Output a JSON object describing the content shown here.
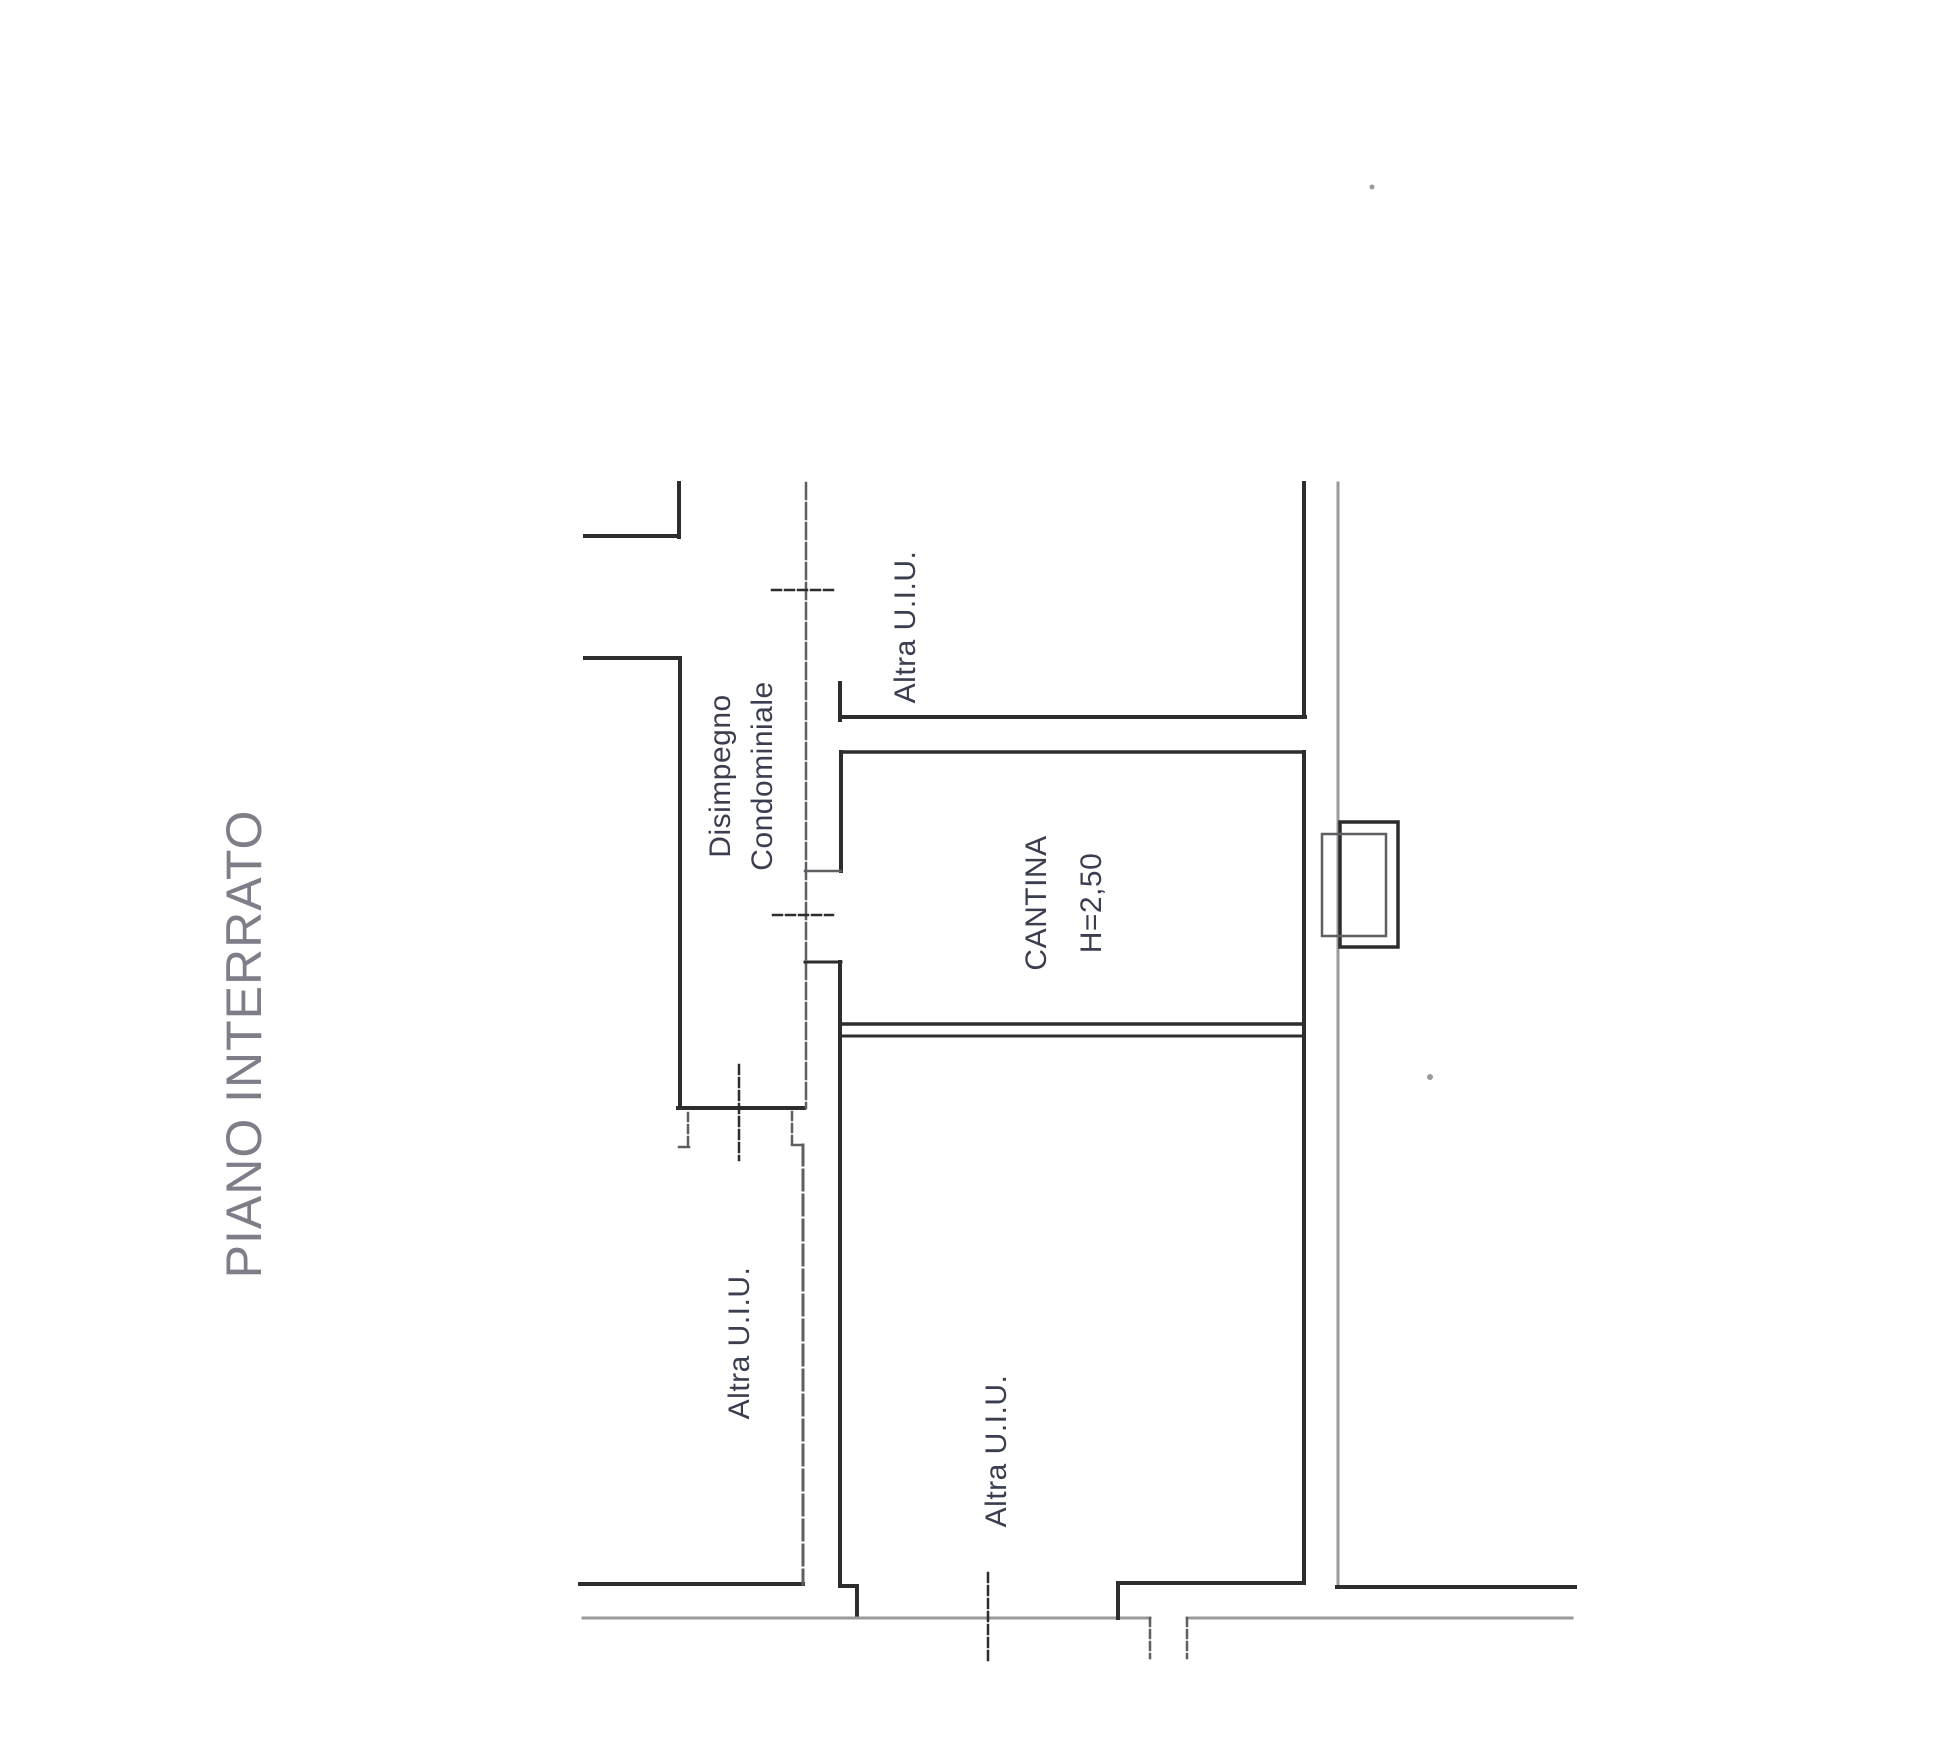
{
  "labels": {
    "floor_title": "PIANO INTERRATO",
    "corridor_line1": "Disimpegno",
    "corridor_line2": "Condominiale",
    "unit_top": "Altra U.I.U.",
    "unit_left": "Altra U.I.U.",
    "unit_bottom": "Altra U.I.U.",
    "room_name": "CANTINA",
    "room_height": "H=2,50"
  },
  "colors": {
    "ink": "#2d2d2f",
    "mid": "#5f5f63",
    "light": "#9a9a9a",
    "label_ink": "#3a3e4f",
    "title_ink": "#7e7e89"
  },
  "plan": {
    "segments": [
      {
        "name": "upper-notch-wall-v",
        "x1": 679,
        "y1": 483,
        "x2": 679,
        "y2": 537,
        "w": 4,
        "c": "ink",
        "dash": null
      },
      {
        "name": "upper-notch-wall-h",
        "x1": 585,
        "y1": 536,
        "x2": 679,
        "y2": 536,
        "w": 4,
        "c": "ink",
        "dash": null
      },
      {
        "name": "left-stub-wall-h",
        "x1": 585,
        "y1": 658,
        "x2": 680,
        "y2": 658,
        "w": 4,
        "c": "ink",
        "dash": null
      },
      {
        "name": "corridor-left-wall",
        "x1": 680,
        "y1": 658,
        "x2": 680,
        "y2": 1108,
        "w": 4,
        "c": "ink",
        "dash": null
      },
      {
        "name": "corridor-bottom-wall",
        "x1": 678,
        "y1": 1108,
        "x2": 804,
        "y2": 1108,
        "w": 4,
        "c": "ink",
        "dash": null
      },
      {
        "name": "corridor-boundary-line",
        "x1": 806,
        "y1": 483,
        "x2": 806,
        "y2": 1108,
        "w": 2.5,
        "c": "mid",
        "dash": "16 4"
      },
      {
        "name": "cantina-left-stub",
        "x1": 840,
        "y1": 683,
        "x2": 840,
        "y2": 720,
        "w": 4,
        "c": "ink",
        "dash": null
      },
      {
        "name": "cantina-top-wall-outer",
        "x1": 840,
        "y1": 717,
        "x2": 1305,
        "y2": 717,
        "w": 4,
        "c": "ink",
        "dash": null
      },
      {
        "name": "cantina-top-wall-inner",
        "x1": 842,
        "y1": 752,
        "x2": 1304,
        "y2": 752,
        "w": 3.5,
        "c": "ink",
        "dash": null
      },
      {
        "name": "cantina-left-wall-upper",
        "x1": 841,
        "y1": 752,
        "x2": 841,
        "y2": 871,
        "w": 4,
        "c": "ink",
        "dash": null
      },
      {
        "name": "cantina-door-jamb-top",
        "x1": 805,
        "y1": 871,
        "x2": 841,
        "y2": 871,
        "w": 2.5,
        "c": "mid",
        "dash": null
      },
      {
        "name": "cantina-door-jamb-bottom",
        "x1": 805,
        "y1": 962,
        "x2": 841,
        "y2": 962,
        "w": 3,
        "c": "ink",
        "dash": null
      },
      {
        "name": "cantina-left-wall-lower",
        "x1": 840,
        "y1": 962,
        "x2": 840,
        "y2": 1586,
        "w": 4,
        "c": "ink",
        "dash": null
      },
      {
        "name": "bottom-jog-h",
        "x1": 840,
        "y1": 1586,
        "x2": 857,
        "y2": 1586,
        "w": 4,
        "c": "ink",
        "dash": null
      },
      {
        "name": "bottom-jog-v",
        "x1": 857,
        "y1": 1586,
        "x2": 857,
        "y2": 1617,
        "w": 4,
        "c": "ink",
        "dash": null
      },
      {
        "name": "cantina-bottom-wall-outer",
        "x1": 840,
        "y1": 1024,
        "x2": 1303,
        "y2": 1024,
        "w": 3.5,
        "c": "ink",
        "dash": null
      },
      {
        "name": "cantina-bottom-wall-inner",
        "x1": 842,
        "y1": 1036,
        "x2": 1303,
        "y2": 1036,
        "w": 3,
        "c": "ink",
        "dash": null
      },
      {
        "name": "cantina-right-wall-upper",
        "x1": 1304,
        "y1": 483,
        "x2": 1304,
        "y2": 717,
        "w": 4,
        "c": "ink",
        "dash": null
      },
      {
        "name": "cantina-right-wall-lower",
        "x1": 1304,
        "y1": 752,
        "x2": 1304,
        "y2": 1583,
        "w": 4,
        "c": "ink",
        "dash": null
      },
      {
        "name": "outer-right-wall",
        "x1": 1338,
        "y1": 483,
        "x2": 1338,
        "y2": 1587,
        "w": 3,
        "c": "light",
        "dash": null
      },
      {
        "name": "bottom-wall-left-outer",
        "x1": 580,
        "y1": 1584,
        "x2": 803,
        "y2": 1584,
        "w": 4,
        "c": "ink",
        "dash": null
      },
      {
        "name": "lower-partition-wall",
        "x1": 803,
        "y1": 1145,
        "x2": 803,
        "y2": 1584,
        "w": 3,
        "c": "mid",
        "dash": "20 5"
      },
      {
        "name": "lower-partition-jog",
        "x1": 792,
        "y1": 1112,
        "x2": 792,
        "y2": 1145,
        "w": 2.5,
        "c": "mid",
        "dash": "8 4"
      },
      {
        "name": "lower-partition-jog-h",
        "x1": 792,
        "y1": 1145,
        "x2": 803,
        "y2": 1145,
        "w": 2.5,
        "c": "mid",
        "dash": null
      },
      {
        "name": "bottom-baseline-left",
        "x1": 583,
        "y1": 1618,
        "x2": 1150,
        "y2": 1618,
        "w": 3,
        "c": "light",
        "dash": null
      },
      {
        "name": "bottom-baseline-right",
        "x1": 1187,
        "y1": 1618,
        "x2": 1572,
        "y2": 1618,
        "w": 3,
        "c": "light",
        "dash": null
      },
      {
        "name": "bottom-wall-mid-outer",
        "x1": 1118,
        "y1": 1583,
        "x2": 1302,
        "y2": 1583,
        "w": 4,
        "c": "ink",
        "dash": null
      },
      {
        "name": "bottom-wall-mid-corner",
        "x1": 1118,
        "y1": 1583,
        "x2": 1118,
        "y2": 1618,
        "w": 4,
        "c": "ink",
        "dash": null
      },
      {
        "name": "bottom-wall-right-outer",
        "x1": 1337,
        "y1": 1587,
        "x2": 1575,
        "y2": 1587,
        "w": 4,
        "c": "ink",
        "dash": null
      },
      {
        "name": "door-tick-top",
        "x1": 772,
        "y1": 590,
        "x2": 833,
        "y2": 590,
        "w": 2.5,
        "c": "ink",
        "dash": "9 4"
      },
      {
        "name": "door-tick-cantina",
        "x1": 773,
        "y1": 915,
        "x2": 833,
        "y2": 915,
        "w": 2.5,
        "c": "ink",
        "dash": "9 4"
      },
      {
        "name": "door-tick-corridor",
        "x1": 739,
        "y1": 1065,
        "x2": 739,
        "y2": 1160,
        "w": 2.5,
        "c": "ink",
        "dash": "9 4"
      },
      {
        "name": "door-tick-hook-v",
        "x1": 688,
        "y1": 1113,
        "x2": 688,
        "y2": 1146,
        "w": 2.5,
        "c": "mid",
        "dash": "8 4"
      },
      {
        "name": "door-tick-hook-h",
        "x1": 679,
        "y1": 1147,
        "x2": 689,
        "y2": 1147,
        "w": 2.5,
        "c": "mid",
        "dash": null
      },
      {
        "name": "door-tick-bottom",
        "x1": 988,
        "y1": 1573,
        "x2": 988,
        "y2": 1660,
        "w": 2.5,
        "c": "ink",
        "dash": "9 4"
      },
      {
        "name": "entrance-tick-left",
        "x1": 1150,
        "y1": 1618,
        "x2": 1150,
        "y2": 1658,
        "w": 2.5,
        "c": "mid",
        "dash": "8 4"
      },
      {
        "name": "entrance-tick-right",
        "x1": 1187,
        "y1": 1618,
        "x2": 1187,
        "y2": 1658,
        "w": 2.5,
        "c": "mid",
        "dash": "8 4"
      }
    ],
    "rects": [
      {
        "name": "lightwell-outer-box",
        "x": 1340,
        "y": 822,
        "w": 58,
        "h": 125,
        "sw": 3.5,
        "c": "ink"
      },
      {
        "name": "lightwell-inner-box",
        "x": 1322,
        "y": 834,
        "w": 64,
        "h": 102,
        "sw": 2.5,
        "c": "mid"
      }
    ],
    "dots": [
      {
        "name": "scan-speck-top",
        "cx": 1372,
        "cy": 187,
        "r": 2.5,
        "c": "light"
      },
      {
        "name": "scan-speck-right",
        "cx": 1430,
        "cy": 1077,
        "r": 3,
        "c": "light"
      }
    ]
  }
}
